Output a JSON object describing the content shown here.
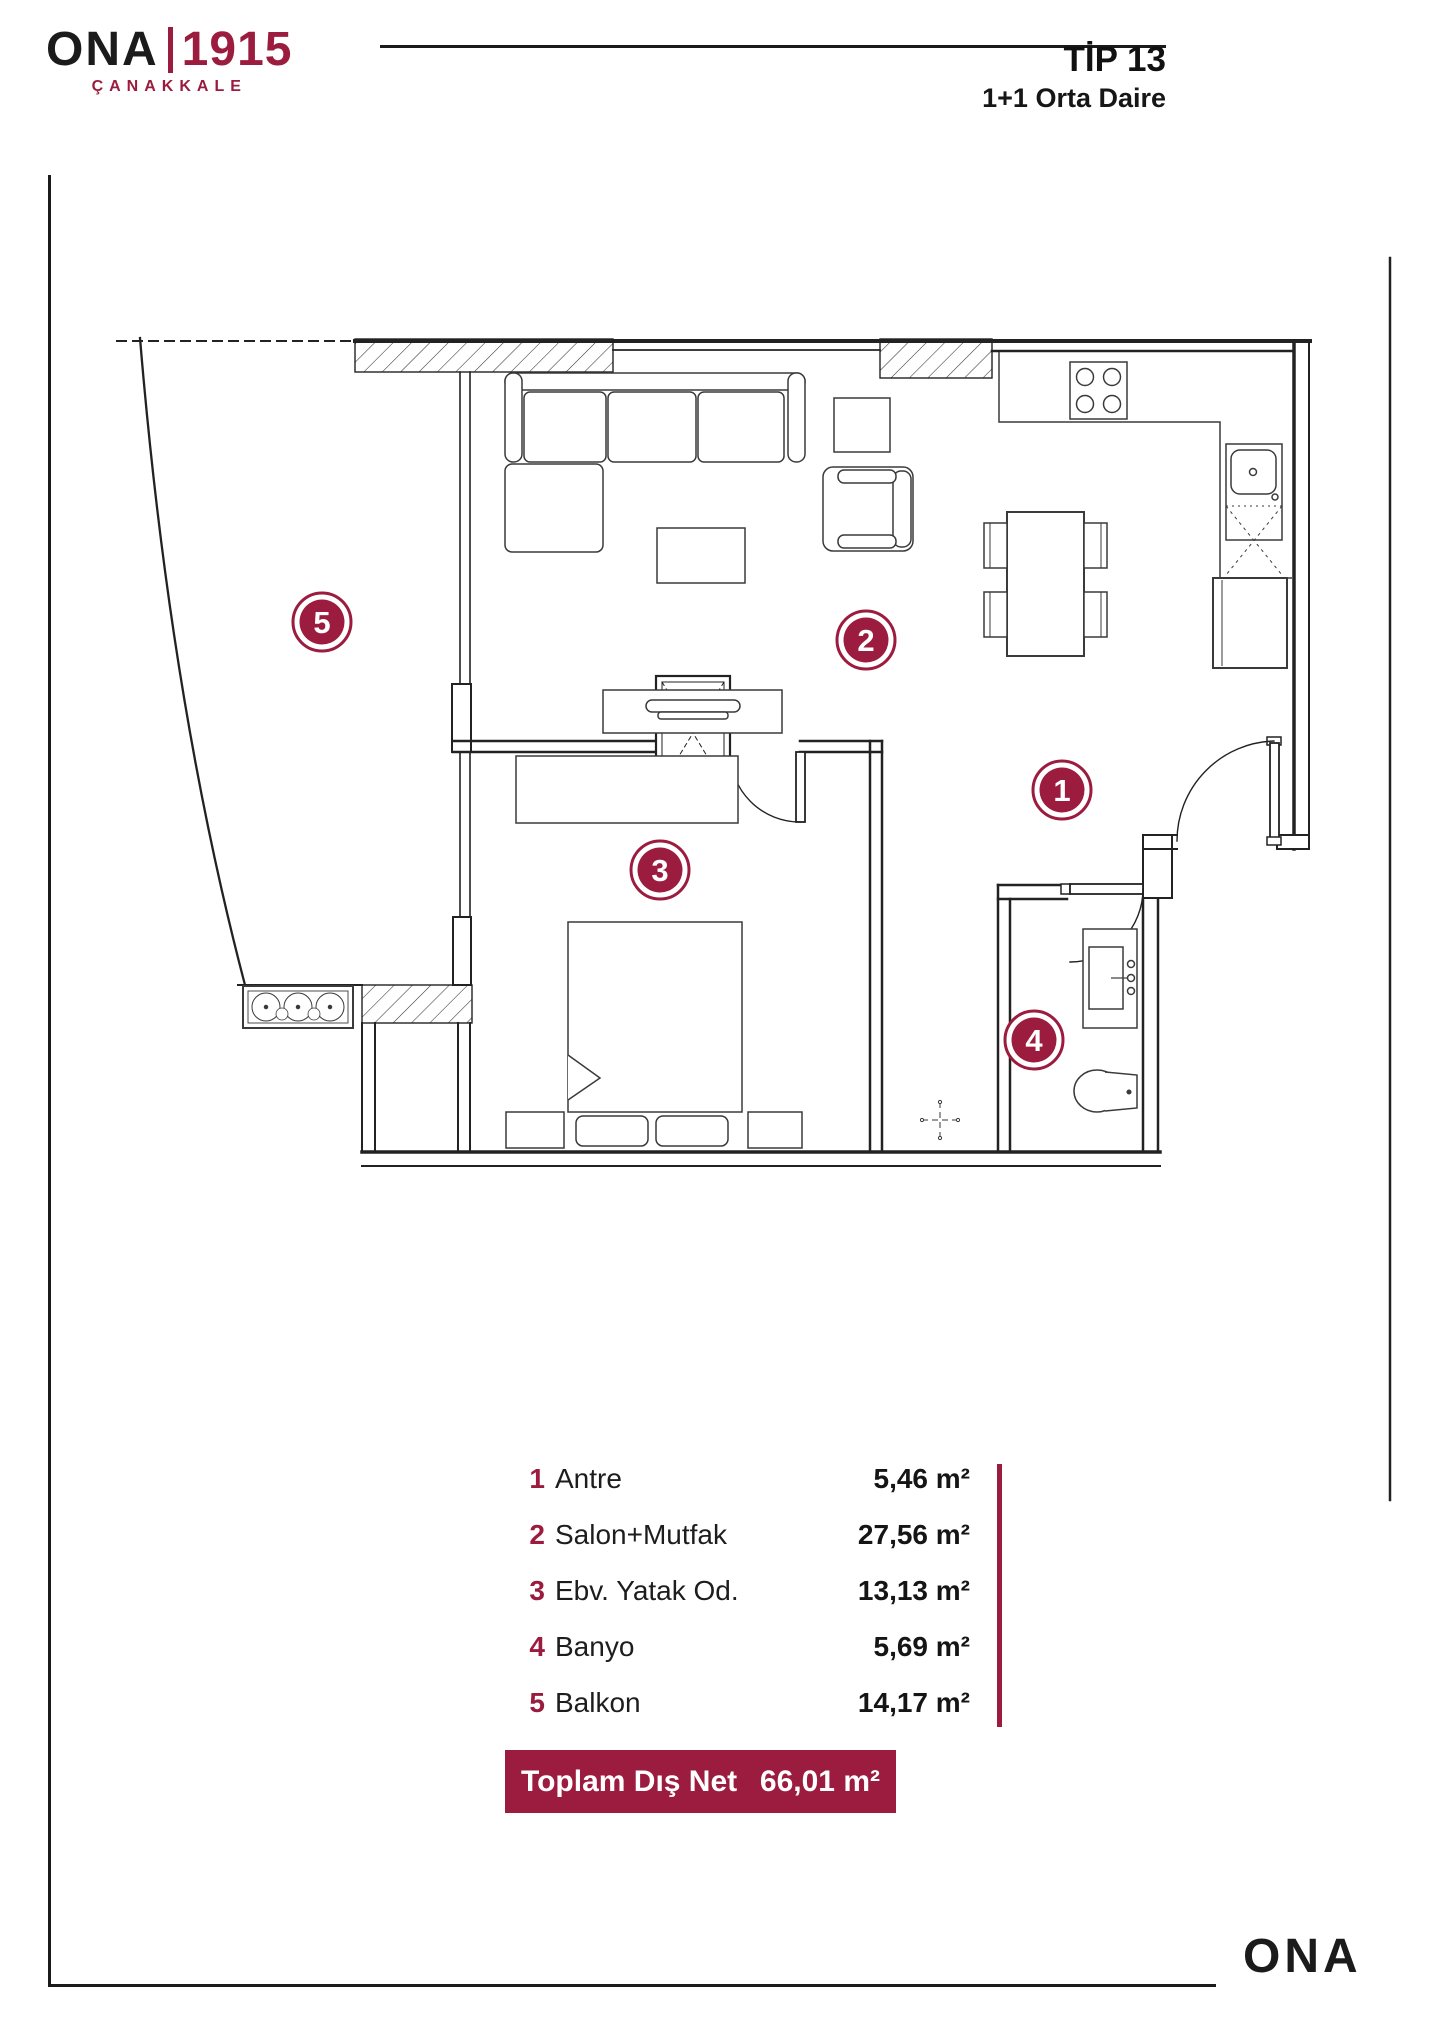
{
  "header": {
    "logo": {
      "ona": "ONA",
      "year": "1915",
      "city": "ÇANAKKALE"
    },
    "title": "TİP 13",
    "subtitle": "1+1 Orta Daire"
  },
  "rooms": [
    {
      "num": "1",
      "name": "Antre",
      "area": "5,46 m²"
    },
    {
      "num": "2",
      "name": "Salon+Mutfak",
      "area": "27,56 m²"
    },
    {
      "num": "3",
      "name": "Ebv. Yatak Od.",
      "area": "13,13 m²"
    },
    {
      "num": "4",
      "name": "Banyo",
      "area": "5,69 m²"
    },
    {
      "num": "5",
      "name": "Balkon",
      "area": "14,17 m²"
    }
  ],
  "total": {
    "label": "Toplam Dış Net",
    "value": "66,01 m²"
  },
  "footer": {
    "logo": "ONA"
  },
  "colors": {
    "maroon": "#9B1C3E",
    "ink": "#1b1b1b"
  }
}
